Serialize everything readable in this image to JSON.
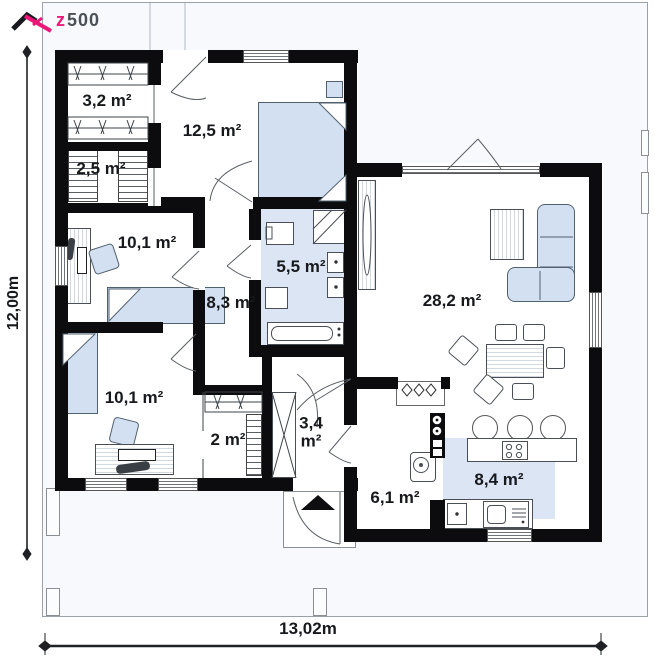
{
  "brand": {
    "z": "z",
    "rest": "500"
  },
  "dimensions": {
    "width_label": "13,02m",
    "height_label": "12,00m"
  },
  "rooms": {
    "wardrobe1": "3,2 m²",
    "bedroom1": "12,5 m²",
    "closet1": "2,5 m²",
    "office": "10,1 m²",
    "bathroom": "5,5 m²",
    "hallway": "8,3 m²",
    "living": "28,2 m²",
    "bedroom2": "10,1 m²",
    "closet2": "2 m²",
    "entry": "3,4 m²",
    "utility": "6,1 m²",
    "kitchen": "8,4 m²"
  },
  "colors": {
    "accent": "#ec1879",
    "wall": "#0c0c0e",
    "furniture": "#d3e0f2",
    "wet-floor": "#dbe5f4",
    "site": "#f7f9fc",
    "outline": "#4a4f57",
    "label": "#17191d"
  }
}
